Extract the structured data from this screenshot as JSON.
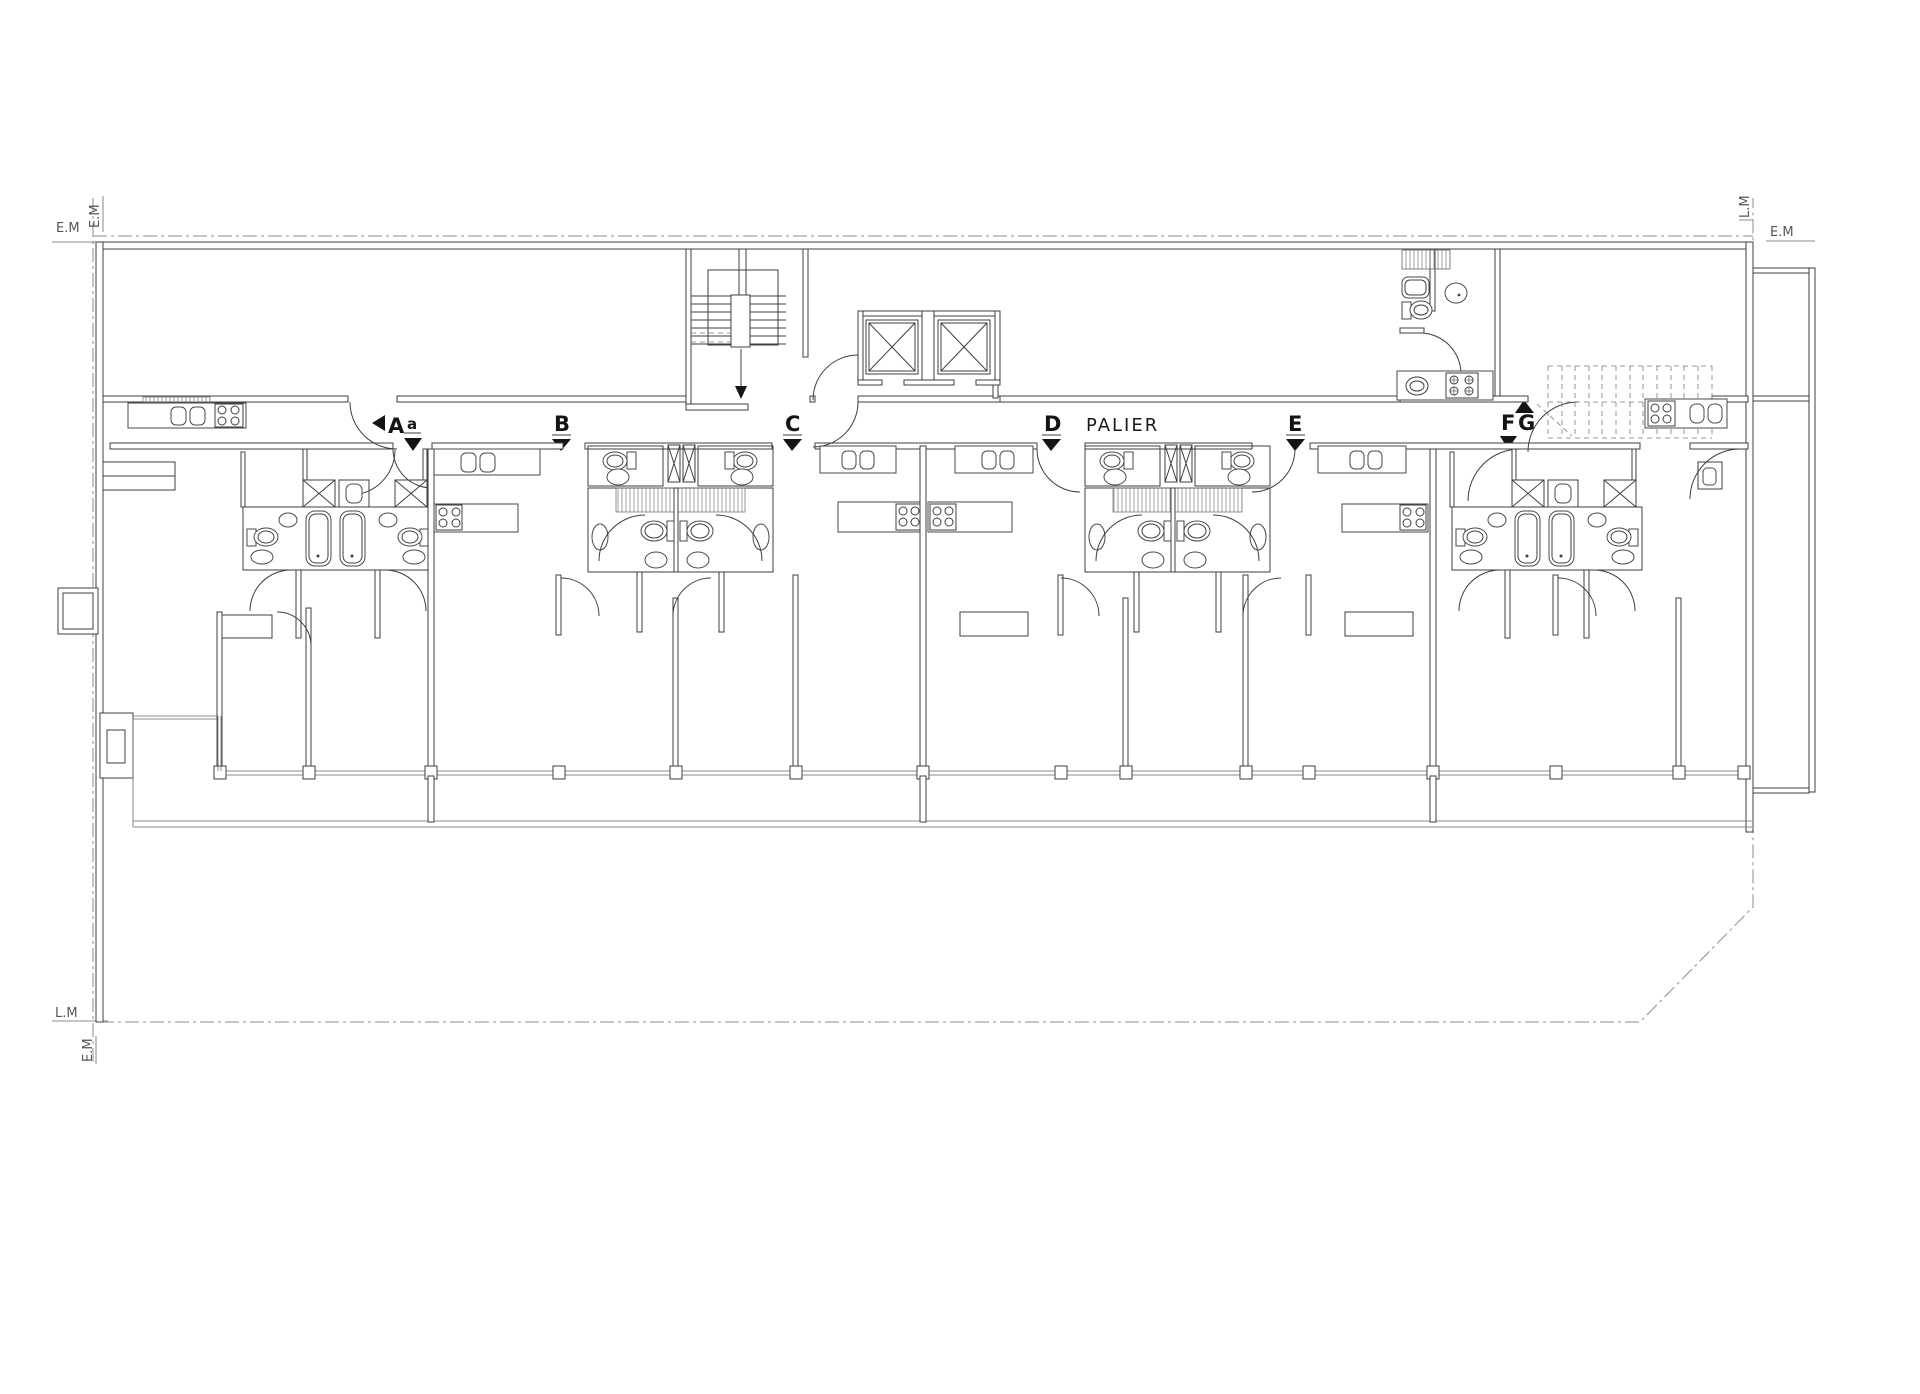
{
  "drawing": {
    "type": "architectural-floor-plan",
    "corridor_label": "PALIER",
    "boundary_labels": {
      "top_left_horizontal": "E.M",
      "top_left_vertical": "E.M",
      "top_right_horizontal": "E.M",
      "top_right_vertical": "L.M",
      "bottom_left_horizontal": "L.M",
      "bottom_left_vertical": "E.M"
    },
    "section_markers": [
      {
        "label": "A"
      },
      {
        "label": "a"
      },
      {
        "label": "B"
      },
      {
        "label": "C"
      },
      {
        "label": "D"
      },
      {
        "label": "E"
      },
      {
        "label": "F"
      },
      {
        "label": "G"
      }
    ],
    "icons": {
      "stairs": "stairs-icon",
      "elevator": "elevator-x-cab-icon",
      "shaft": "duct-x-icon",
      "bathtub": "bathtub-icon",
      "toilet": "toilet-icon",
      "bidet": "bidet-icon",
      "washbasin": "washbasin-icon",
      "kitchen_sink": "kitchen-sink-icon",
      "stove": "four-burner-stove-icon",
      "door": "door-swing-arc",
      "trellis": "trellis-grid"
    },
    "colors": {
      "background": "#ffffff",
      "wall_line": "#3f3f3f",
      "boundary_line": "#8c8c8c",
      "annotation_text": "#555555",
      "marker_text": "#141414"
    }
  }
}
